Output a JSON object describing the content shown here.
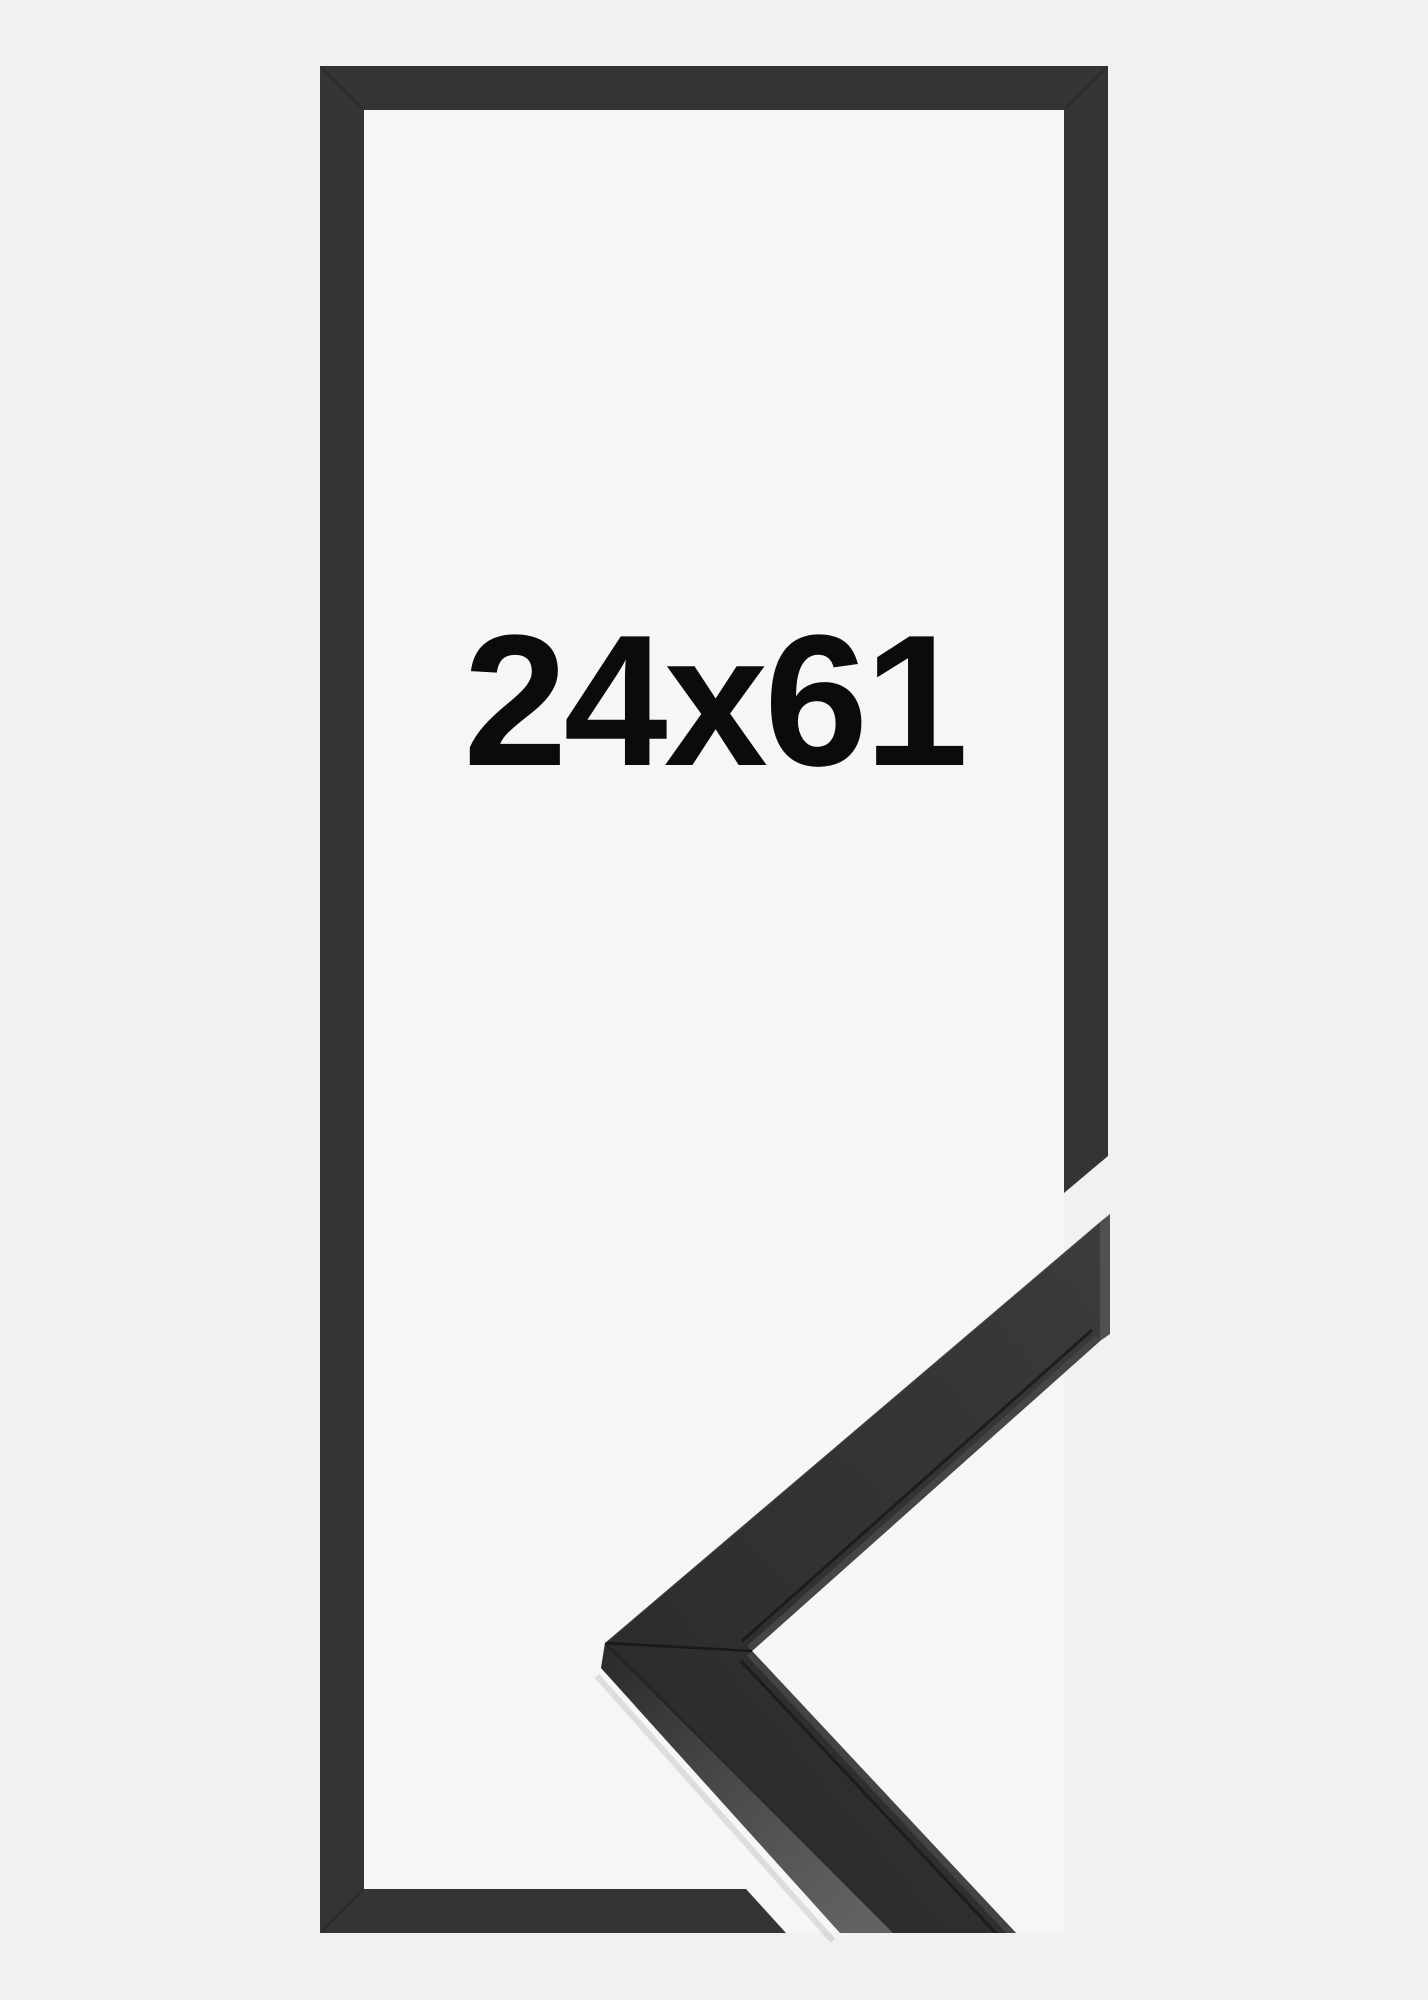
{
  "image": {
    "type": "product-photo",
    "subject": "black picture frame with corner profile detail",
    "size_label": "24x61"
  },
  "colors": {
    "background": "#f1f1f1",
    "frame_interior": "#f6f6f5",
    "frame_outline": "#333436",
    "moulding_front": "#373737",
    "moulding_side": "#575757",
    "moulding_end": "#565656",
    "label_text": "#0b0b0b"
  }
}
